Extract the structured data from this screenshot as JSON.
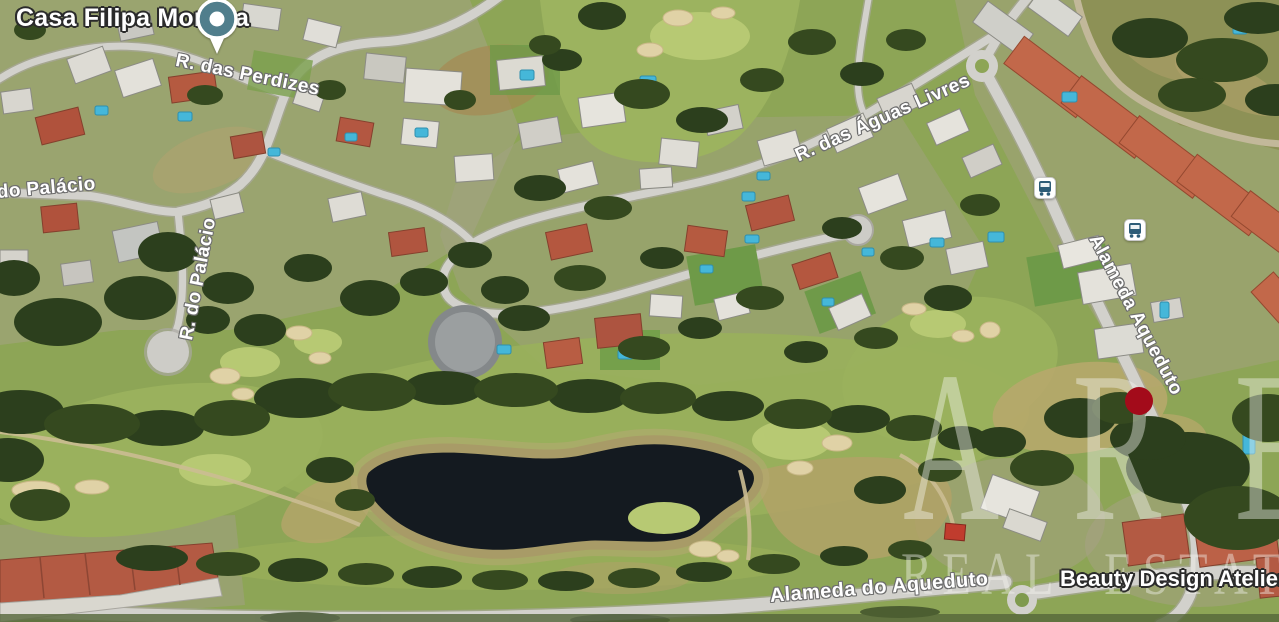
{
  "map": {
    "view_type": "satellite-aerial",
    "labels": {
      "poi_top": "Casa Filipa Moreira",
      "poi_bottom": "Beauty Design Atelier 2",
      "roads": {
        "perdizes": "R. das Perdizes",
        "do_palacio": "do Palácio",
        "r_do_palacio": "R. do Palácio",
        "aguas_livres": "R. das Águas Livres",
        "alameda_aqueduto": "Alameda Aqueduto",
        "alameda_do_aqueduto": "Alameda do Aqueduto"
      }
    },
    "icons": {
      "poi_pin": "place-pin",
      "bus_stop_north": "bus-stop",
      "bus_stop_south": "bus-stop",
      "property_marker": "red-dot"
    },
    "colors": {
      "pin_teal": "#507e8c",
      "marker_red": "#a30b1a",
      "bus_glyph_blue": "#2d5c77",
      "water": "#141a20",
      "fairway_green": "#8da556"
    },
    "watermark": {
      "line1": "ARE",
      "line2": "REAL ESTATE"
    }
  }
}
